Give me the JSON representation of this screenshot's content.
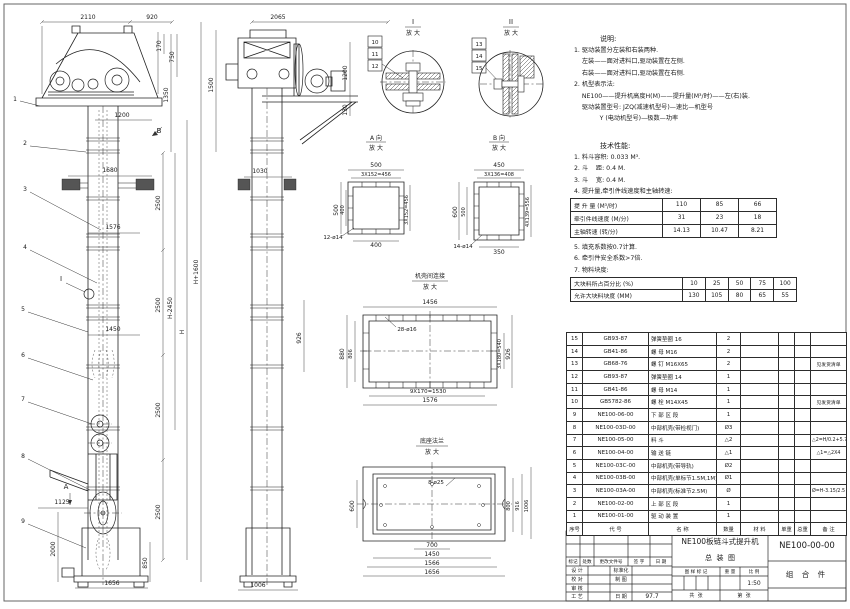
{
  "notes": {
    "title": "说明:",
    "items": [
      "1. 驱动装置分左装和右装两种.",
      "    左装——面对进料口,驱动装置在左侧.",
      "    右装——面对进料口,驱动装置在右侧.",
      "2. 机型表示法:",
      "    NE100——提升机高度H(M)——提升量(M³/时)——左(右)装.",
      "    驱动装置型号: JZQ(减速机型号)—速比—机型号",
      "             Y (电动机型号)—极数—功率"
    ]
  },
  "tech": {
    "title": "技术性能:",
    "items_top": [
      "1. 料斗容积: 0.033 M³.",
      "2. 斗    距: 0.4 M.",
      "3. 斗    宽: 0.4 M.",
      "4. 提升量,牵引件线速度和主轴转速:"
    ],
    "speed_table": {
      "rows": [
        {
          "label": "提 升 量  (M³/时)",
          "values": [
            "110",
            "85",
            "66"
          ]
        },
        {
          "label": "牵引件线速度 (M/分)",
          "values": [
            "31",
            "23",
            "18"
          ]
        },
        {
          "label": "主轴转速 (转/分)",
          "values": [
            "14.13",
            "10.47",
            "8.21"
          ]
        }
      ]
    },
    "items_mid": [
      "5. 填充系数按0.7计算.",
      "6. 牵引件安全系数>7倍.",
      "7. 物料块度:"
    ],
    "size_table": {
      "rows": [
        {
          "label": "大块料所占百分比 (%)",
          "values": [
            "10",
            "25",
            "50",
            "75",
            "100"
          ]
        },
        {
          "label": "允许大块料块度 (MM)",
          "values": [
            "130",
            "105",
            "80",
            "65",
            "55"
          ]
        }
      ]
    }
  },
  "parts": {
    "header": [
      "序号",
      "代  号",
      "名  称",
      "数量",
      "材  料",
      "单重",
      "总重",
      "备  注"
    ],
    "rows": [
      {
        "no": "15",
        "code": "GB93-87",
        "name": "弹簧垫圈 16",
        "qty": "2",
        "mat": "",
        "uw": "",
        "tw": "",
        "remark": ""
      },
      {
        "no": "14",
        "code": "GB41-86",
        "name": "螺 母 M16",
        "qty": "2",
        "mat": "",
        "uw": "",
        "tw": "",
        "remark": ""
      },
      {
        "no": "13",
        "code": "GB68-76",
        "name": "螺 钉 M16X65",
        "qty": "2",
        "mat": "",
        "uw": "",
        "tw": "",
        "remark": "见发货清单"
      },
      {
        "no": "12",
        "code": "GB93-87",
        "name": "弹簧垫圈 14",
        "qty": "1",
        "mat": "",
        "uw": "",
        "tw": "",
        "remark": ""
      },
      {
        "no": "11",
        "code": "GB41-86",
        "name": "螺 母 M14",
        "qty": "1",
        "mat": "",
        "uw": "",
        "tw": "",
        "remark": ""
      },
      {
        "no": "10",
        "code": "GB5782-86",
        "name": "螺 栓 M14X45",
        "qty": "1",
        "mat": "",
        "uw": "",
        "tw": "",
        "remark": "见发货清单"
      },
      {
        "no": "9",
        "code": "NE100-06-00",
        "name": "下 部 区 段",
        "qty": "1",
        "mat": "",
        "uw": "",
        "tw": "",
        "remark": ""
      },
      {
        "no": "8",
        "code": "NE100-03D-00",
        "name": "中部机壳(带检视门)",
        "qty": "Ø3",
        "mat": "",
        "uw": "",
        "tw": "",
        "remark": ""
      },
      {
        "no": "7",
        "code": "NE100-05-00",
        "name": "料 斗",
        "qty": "△2",
        "mat": "",
        "uw": "",
        "tw": "",
        "remark": "△2=H/0.2+5.75"
      },
      {
        "no": "6",
        "code": "NE100-04-00",
        "name": "输 送 链",
        "qty": "△1",
        "mat": "",
        "uw": "",
        "tw": "",
        "remark": "△1=△2X4"
      },
      {
        "no": "5",
        "code": "NE100-03C-00",
        "name": "中部机壳(带导轨)",
        "qty": "Ø2",
        "mat": "",
        "uw": "",
        "tw": "",
        "remark": ""
      },
      {
        "no": "4",
        "code": "NE100-03B-00",
        "name": "中部机壳(单标节1.5M,1M)",
        "qty": "Ø1",
        "mat": "",
        "uw": "",
        "tw": "",
        "remark": ""
      },
      {
        "no": "3",
        "code": "NE100-03A-00",
        "name": "中部机壳(标准节2.5M)",
        "qty": "Ø",
        "mat": "",
        "uw": "",
        "tw": "",
        "remark": "Ø=H-3.15/2.5"
      },
      {
        "no": "2",
        "code": "NE100-02-00",
        "name": "上 部 区 段",
        "qty": "1",
        "mat": "",
        "uw": "",
        "tw": "",
        "remark": ""
      },
      {
        "no": "1",
        "code": "NE100-01-00",
        "name": "驱 动 装 置",
        "qty": "1",
        "mat": "",
        "uw": "",
        "tw": "",
        "remark": ""
      }
    ]
  },
  "titleblock": {
    "rev_labels": [
      "标记",
      "处数",
      "更改文件号",
      "签 字",
      "日 期"
    ],
    "design": "设 计",
    "standard": "标准化",
    "check": "校 对",
    "draft": "制 图",
    "audit": "审 核",
    "craft": "工 艺",
    "date_label": "日 期",
    "date": "97.7",
    "stamp": "图 样 标 记",
    "weight": "重 量",
    "scale_label": "比 例",
    "scale": "1:50",
    "sheets": "共  张",
    "page": "第  张",
    "title1": "NE100板链斗式提升机",
    "title2": "总  装  图",
    "dwg_no": "NE100-00-00",
    "part_type": "组 合 件"
  },
  "drawing_labels": [
    {
      "t": "2110",
      "x": 88,
      "y": 19
    },
    {
      "t": "920",
      "x": 152,
      "y": 19
    },
    {
      "t": "170",
      "x": 161,
      "y": 46,
      "r": 1
    },
    {
      "t": "750",
      "x": 174,
      "y": 57,
      "r": 1
    },
    {
      "t": "1350",
      "x": 168,
      "y": 95,
      "r": 1
    },
    {
      "t": "1500",
      "x": 213,
      "y": 85,
      "r": 1
    },
    {
      "t": "1200",
      "x": 122,
      "y": 117
    },
    {
      "t": "1680",
      "x": 110,
      "y": 172
    },
    {
      "t": "1576",
      "x": 113,
      "y": 229
    },
    {
      "t": "1450",
      "x": 113,
      "y": 331
    },
    {
      "t": "2500",
      "x": 160,
      "y": 203,
      "r": 1
    },
    {
      "t": "2500",
      "x": 160,
      "y": 305,
      "r": 1
    },
    {
      "t": "2500",
      "x": 160,
      "y": 410,
      "r": 1
    },
    {
      "t": "2500",
      "x": 160,
      "y": 512,
      "r": 1
    },
    {
      "t": "850",
      "x": 147,
      "y": 563,
      "r": 1
    },
    {
      "t": "H-2450",
      "x": 172,
      "y": 308,
      "r": 1
    },
    {
      "t": "H",
      "x": 184,
      "y": 332,
      "r": 1
    },
    {
      "t": "H+1600",
      "x": 198,
      "y": 272,
      "r": 1
    },
    {
      "t": "1125",
      "x": 62,
      "y": 504
    },
    {
      "t": "2000",
      "x": 55,
      "y": 549,
      "r": 1
    },
    {
      "t": "1656",
      "x": 112,
      "y": 585
    },
    {
      "t": "1",
      "x": 15,
      "y": 101
    },
    {
      "t": "2",
      "x": 25,
      "y": 145
    },
    {
      "t": "3",
      "x": 25,
      "y": 191
    },
    {
      "t": "4",
      "x": 25,
      "y": 249
    },
    {
      "t": "5",
      "x": 23,
      "y": 311
    },
    {
      "t": "6",
      "x": 23,
      "y": 357
    },
    {
      "t": "7",
      "x": 23,
      "y": 401
    },
    {
      "t": "8",
      "x": 23,
      "y": 458
    },
    {
      "t": "9",
      "x": 23,
      "y": 523
    },
    {
      "t": "B",
      "x": 159,
      "y": 133,
      "s": 7
    },
    {
      "t": "A",
      "x": 66,
      "y": 489,
      "s": 7
    },
    {
      "t": "I",
      "x": 61,
      "y": 281,
      "s": 7
    },
    {
      "t": "2065",
      "x": 278,
      "y": 19
    },
    {
      "t": "1200",
      "x": 347,
      "y": 73,
      "r": 1
    },
    {
      "t": "130",
      "x": 347,
      "y": 110,
      "r": 1
    },
    {
      "t": "1030",
      "x": 260,
      "y": 173
    },
    {
      "t": "926",
      "x": 301,
      "y": 338,
      "r": 1
    },
    {
      "t": "1006",
      "x": 258,
      "y": 587
    },
    {
      "t": "10",
      "x": 375,
      "y": 44,
      "s": 5.5
    },
    {
      "t": "11",
      "x": 375,
      "y": 56,
      "s": 5.5
    },
    {
      "t": "12",
      "x": 375,
      "y": 68,
      "s": 5.5
    },
    {
      "t": "13",
      "x": 479,
      "y": 46,
      "s": 5.5
    },
    {
      "t": "14",
      "x": 479,
      "y": 58,
      "s": 5.5
    },
    {
      "t": "15",
      "x": 479,
      "y": 70,
      "s": 5.5
    },
    {
      "t": "I",
      "x": 413,
      "y": 24,
      "s": 7
    },
    {
      "t": "放 大",
      "x": 413,
      "y": 35,
      "s": 6
    },
    {
      "t": "II",
      "x": 511,
      "y": 24,
      "s": 7
    },
    {
      "t": "放 大",
      "x": 511,
      "y": 35,
      "s": 6
    },
    {
      "t": "A 向",
      "x": 376,
      "y": 140,
      "s": 6
    },
    {
      "t": "放 大",
      "x": 376,
      "y": 150,
      "s": 6
    },
    {
      "t": "500",
      "x": 376,
      "y": 167
    },
    {
      "t": "3X152=456",
      "x": 376,
      "y": 176,
      "s": 5
    },
    {
      "t": "500",
      "x": 338,
      "y": 210,
      "r": 1
    },
    {
      "t": "400",
      "x": 344,
      "y": 210,
      "r": 1,
      "s": 5
    },
    {
      "t": "3X152=456",
      "x": 408,
      "y": 210,
      "r": 1,
      "s": 5
    },
    {
      "t": "400",
      "x": 376,
      "y": 247
    },
    {
      "t": "12-ø14",
      "x": 333,
      "y": 239,
      "s": 5.5
    },
    {
      "t": "B 向",
      "x": 499,
      "y": 140,
      "s": 6
    },
    {
      "t": "放 大",
      "x": 499,
      "y": 150,
      "s": 6
    },
    {
      "t": "450",
      "x": 499,
      "y": 167
    },
    {
      "t": "3X136=408",
      "x": 499,
      "y": 176,
      "s": 5
    },
    {
      "t": "600",
      "x": 457,
      "y": 212,
      "r": 1
    },
    {
      "t": "500",
      "x": 465,
      "y": 212,
      "r": 1,
      "s": 5
    },
    {
      "t": "4X139=556",
      "x": 529,
      "y": 212,
      "r": 1,
      "s": 5
    },
    {
      "t": "350",
      "x": 499,
      "y": 254
    },
    {
      "t": "14-ø14",
      "x": 463,
      "y": 248,
      "s": 5.5
    },
    {
      "t": "机壳间连接",
      "x": 430,
      "y": 278,
      "s": 6
    },
    {
      "t": "放 大",
      "x": 430,
      "y": 289,
      "s": 6
    },
    {
      "t": "1456",
      "x": 430,
      "y": 304
    },
    {
      "t": "28-ø16",
      "x": 407,
      "y": 331,
      "s": 5.5
    },
    {
      "t": "880",
      "x": 344,
      "y": 354,
      "r": 1
    },
    {
      "t": "806",
      "x": 352,
      "y": 354,
      "r": 1,
      "s": 5
    },
    {
      "t": "3X180=540",
      "x": 501,
      "y": 354,
      "r": 1,
      "s": 5
    },
    {
      "t": "926",
      "x": 510,
      "y": 354,
      "r": 1
    },
    {
      "t": "9X170=1530",
      "x": 428,
      "y": 393,
      "s": 5.5
    },
    {
      "t": "1576",
      "x": 430,
      "y": 402
    },
    {
      "t": "底座法兰",
      "x": 432,
      "y": 443,
      "s": 6
    },
    {
      "t": "放 大",
      "x": 432,
      "y": 454,
      "s": 6
    },
    {
      "t": "8-ø25",
      "x": 436,
      "y": 484,
      "s": 5.5
    },
    {
      "t": "600",
      "x": 354,
      "y": 506,
      "r": 1
    },
    {
      "t": "800",
      "x": 510,
      "y": 506,
      "r": 1,
      "s": 5
    },
    {
      "t": "916",
      "x": 519,
      "y": 506,
      "r": 1,
      "s": 5
    },
    {
      "t": "1006",
      "x": 528,
      "y": 506,
      "r": 1,
      "s": 5
    },
    {
      "t": "700",
      "x": 432,
      "y": 547
    },
    {
      "t": "1450",
      "x": 432,
      "y": 556
    },
    {
      "t": "1566",
      "x": 432,
      "y": 565
    },
    {
      "t": "1656",
      "x": 432,
      "y": 574
    }
  ]
}
